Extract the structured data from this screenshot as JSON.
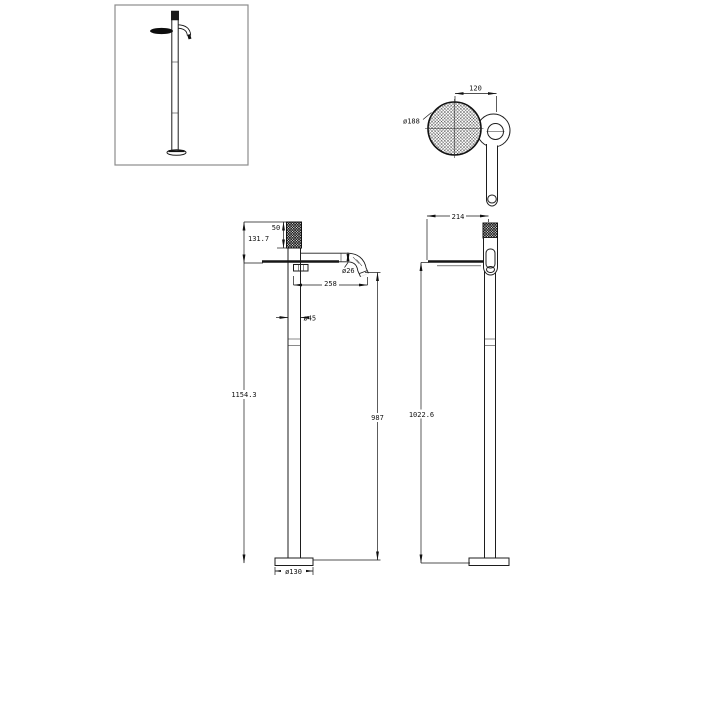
{
  "title": "Freestanding bath mixer technical drawing",
  "colors": {
    "line": "#1a1a1a",
    "background": "#ffffff",
    "frame": "#8c8c8c"
  },
  "views": {
    "thumbnail": {
      "name": "product-overview"
    },
    "top": {
      "labels": {
        "handle_offset": "120",
        "head_diameter": "ø188"
      }
    },
    "front": {
      "labels": {
        "cap_height": "50",
        "head_drop": "131.7",
        "spout_diameter": "ø26",
        "spout_reach": "258",
        "column_diameter": "ø45",
        "overall_height": "1154.3",
        "spout_outlet_height": "987",
        "base_diameter": "ø130"
      }
    },
    "side": {
      "labels": {
        "depth": "214",
        "shelf_height": "1022.6"
      }
    }
  }
}
